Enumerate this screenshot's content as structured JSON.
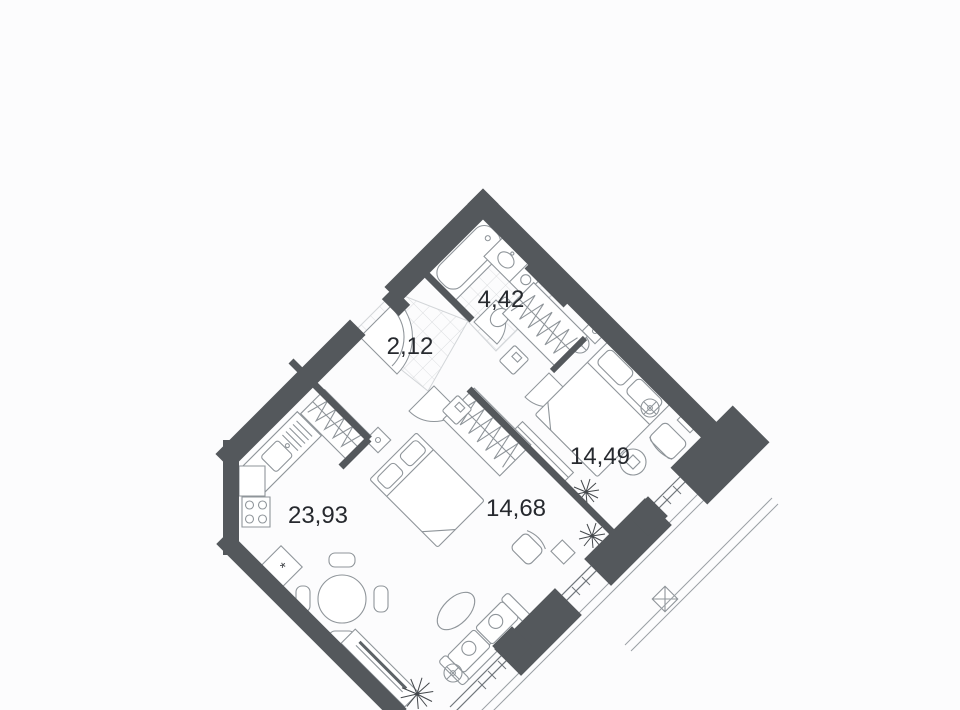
{
  "plan": {
    "kind": "apartment-floor-plan",
    "rotation_degrees": 45,
    "room_count": 5
  },
  "rooms": [
    {
      "id": "bathroom",
      "label": "4,42",
      "x": 501,
      "y": 300
    },
    {
      "id": "hallway",
      "label": "2,12",
      "x": 410,
      "y": 347
    },
    {
      "id": "bedroom-right",
      "label": "14,49",
      "x": 600,
      "y": 457
    },
    {
      "id": "bedroom-middle",
      "label": "14,68",
      "x": 516,
      "y": 509
    },
    {
      "id": "kitchen-living-room",
      "label": "23,93",
      "x": 318,
      "y": 516
    }
  ],
  "symbols": {
    "kitchen_mark": "*"
  },
  "icons": [
    "bathtub-icon",
    "sink-icon",
    "toilet-icon",
    "stove-icon",
    "kitchen-counter-icon",
    "dining-table-icon",
    "tv-stand-icon",
    "sofa-icon",
    "rug-icon",
    "floor-lamp-icon",
    "bed-icon",
    "nightstand-icon",
    "wardrobe-icon",
    "cabinet-icon",
    "armchair-icon",
    "side-table-icon",
    "plant-icon",
    "door-swing-icon",
    "window-icon",
    "balcony-railing-icon",
    "ac-unit-icon"
  ],
  "colors": {
    "wall": "#54585c",
    "furniture_line": "#8f959a",
    "furniture_line_dark": "#5d6367",
    "tile_line": "#d3d6d9",
    "label_text": "#26292e",
    "background": "#fcfcfd",
    "door_fill": "#ffffff"
  }
}
